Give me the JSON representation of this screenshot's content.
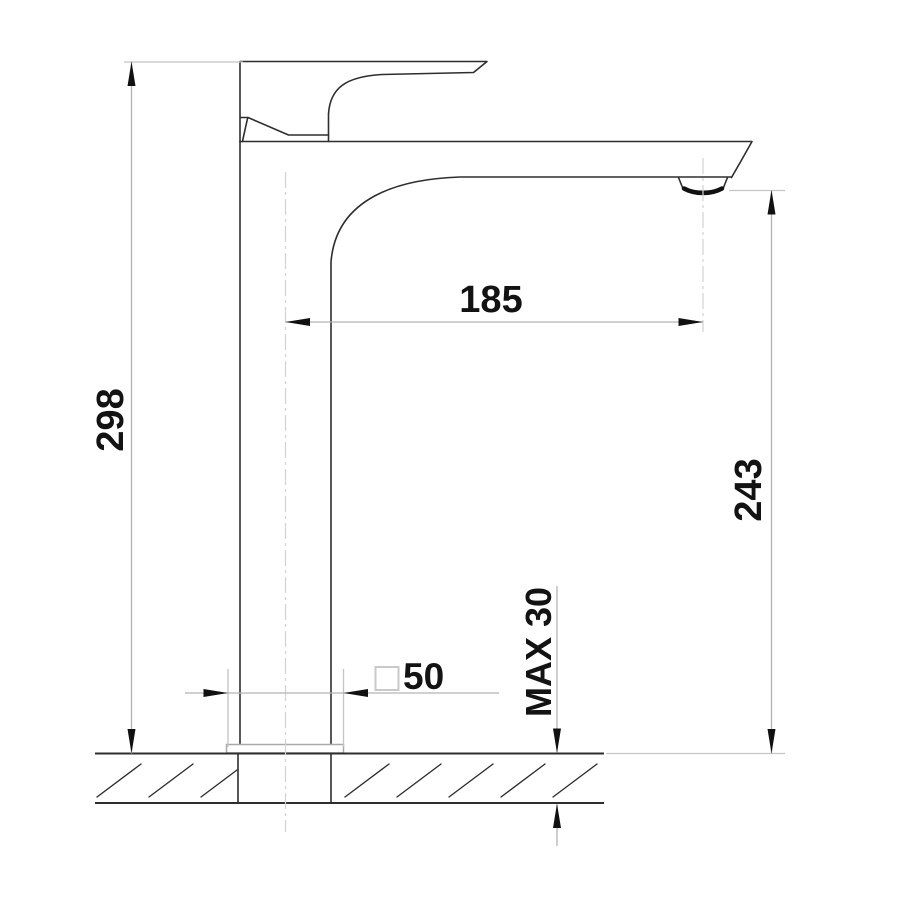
{
  "drawing": {
    "subject": "basin mixer tap side elevation with dimensions",
    "labels": {
      "height_total": "298",
      "spout_reach": "185",
      "spout_outlet_height": "243",
      "base_size": "50",
      "deck_thickness_max": "MAX 30"
    },
    "symbols": {
      "base_size_prefix": "square-symbol"
    },
    "colors": {
      "outline": "#2e2e2e",
      "counter": "#2e2e2e",
      "dimension_line": "#b3b3b3",
      "extension_line": "#c4c4c4",
      "centerline": "#d2d2d2",
      "arrow": "#111111",
      "text": "#131313",
      "base_plate": "#a9a9a9",
      "background": "#ffffff"
    }
  }
}
